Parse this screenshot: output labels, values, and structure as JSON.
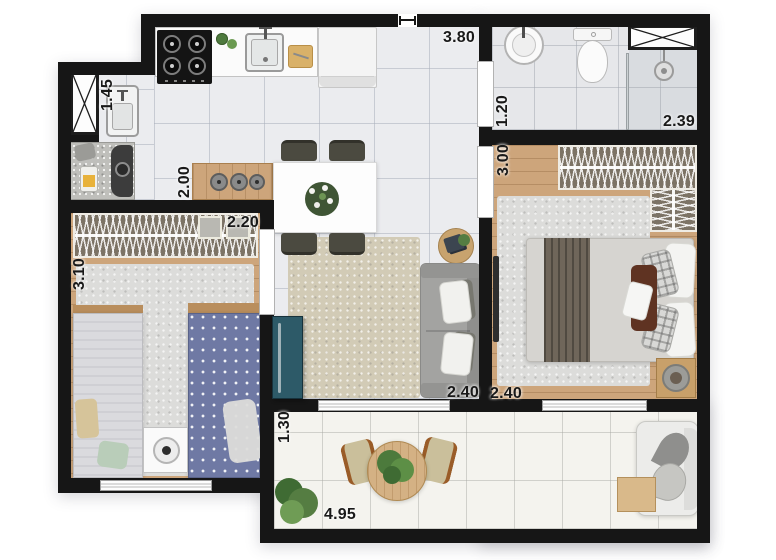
{
  "dimensions": {
    "kitchen_top": "3.80",
    "bathroom_depth": "1.20",
    "shower_width": "2.39",
    "bedroom1_depth": "3.00",
    "laundry_depth": "1.45",
    "kitchen_counter": "2.00",
    "bedroom2_wardrobe": "2.20",
    "bedroom2_depth": "3.10",
    "living_width": "2.40",
    "bedroom1_width": "2.40",
    "balcony_depth": "1.30",
    "balcony_width": "4.95"
  },
  "palette": {
    "wall": "#161616",
    "wood_floor": "#cda57b",
    "tile_light": "#ebecef",
    "balcony_tile": "#f4f3ee",
    "door_accent": "#2d5a68",
    "rug_beige": "#d2cbb6",
    "rug_gray": "#dcdcda"
  }
}
